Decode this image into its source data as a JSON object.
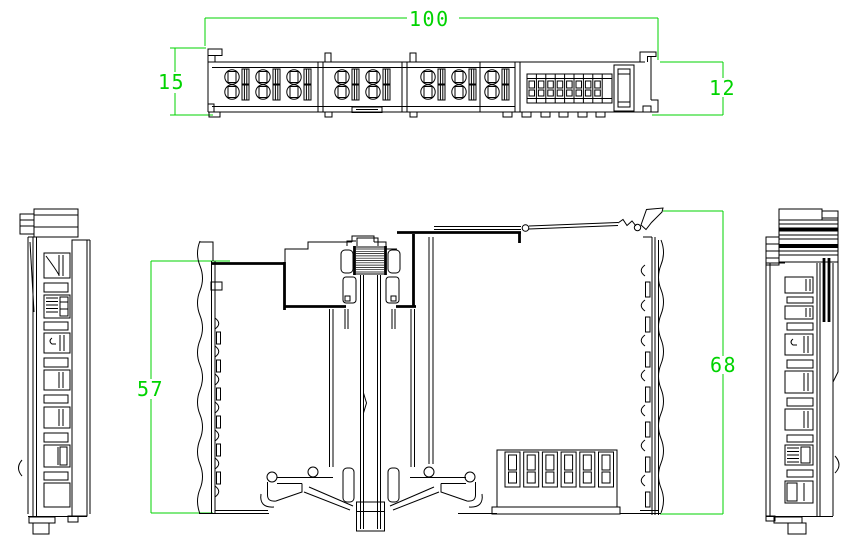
{
  "drawing": {
    "type": "cad-engineering-drawing",
    "subject": "din-rail-terminal-module-three-views",
    "colors": {
      "background": "#ffffff",
      "line": "#000000",
      "dimension": "#00d300"
    },
    "views": [
      {
        "id": "top-view",
        "dimension_labels": [
          "100",
          "15",
          "12"
        ]
      },
      {
        "id": "front-section-view",
        "dimension_labels": [
          "57",
          "68"
        ]
      },
      {
        "id": "left-side-view",
        "dimension_labels": []
      },
      {
        "id": "right-side-view",
        "dimension_labels": []
      }
    ]
  },
  "dimensions": {
    "top_width": "100",
    "top_left_height": "15",
    "top_right_height": "12",
    "front_inner_height": "57",
    "front_overall_height": "68"
  }
}
